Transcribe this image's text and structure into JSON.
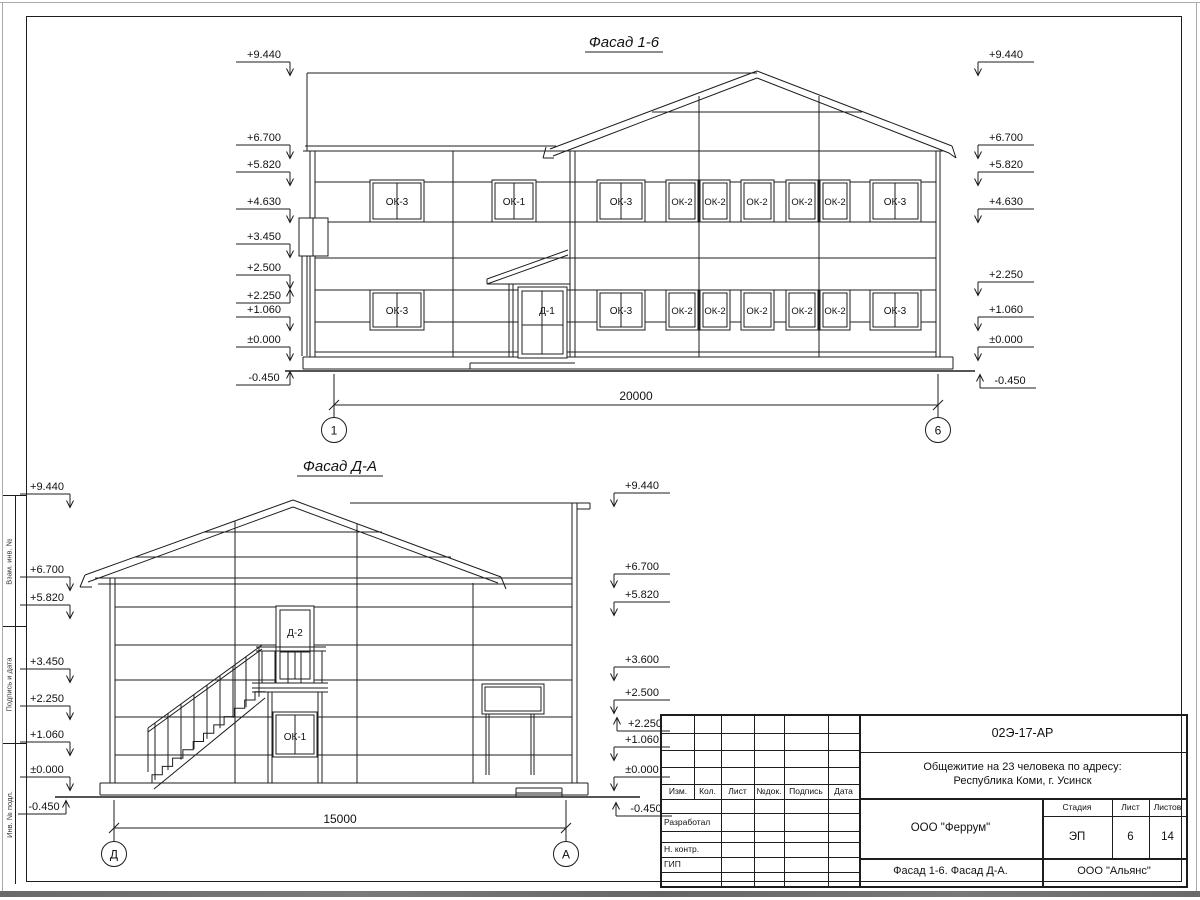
{
  "sheet": {
    "margin_labels": [
      "Взам. инв. №",
      "Подпись и дата",
      "Инв. № подл."
    ]
  },
  "facade_16": {
    "title": "Фасад 1-6",
    "marks_left": [
      "+9.440",
      "+6.700",
      "+5.820",
      "+4.630",
      "+3.450",
      "+2.500",
      "+2.250",
      "+1.060",
      "±0.000",
      "-0.450"
    ],
    "marks_right": [
      "+9.440",
      "+6.700",
      "+5.820",
      "+4.630",
      "+2.250",
      "+1.060",
      "±0.000",
      "-0.450"
    ],
    "upper_windows": [
      "ОК-3",
      "ОК-1",
      "ОК-3",
      "ОК-2",
      "ОК-2",
      "ОК-2",
      "ОК-2",
      "ОК-2",
      "ОК-3"
    ],
    "lower_windows": [
      "ОК-3",
      "ОК-3",
      "ОК-2",
      "ОК-2",
      "ОК-2",
      "ОК-2",
      "ОК-2",
      "ОК-3"
    ],
    "door_label": "Д-1",
    "dimension": "20000",
    "axis_left": "1",
    "axis_right": "6"
  },
  "facade_da": {
    "title": "Фасад Д-А",
    "marks_left": [
      "+9.440",
      "+6.700",
      "+5.820",
      "+3.450",
      "+2.250",
      "+1.060",
      "±0.000",
      "-0.450"
    ],
    "marks_right": [
      "+9.440",
      "+6.700",
      "+5.820",
      "+3.600",
      "+2.500",
      "+2.250",
      "+1.060",
      "±0.000",
      "-0.450"
    ],
    "door_label": "Д-2",
    "window_label": "ОК-1",
    "dimension": "15000",
    "axis_left": "Д",
    "axis_right": "А"
  },
  "title_block": {
    "doc_number": "02Э-17-АР",
    "project_line1": "Общежитие на 23 человека по адресу:",
    "project_line2": "Республика Коми, г. Усинск",
    "col_izm": "Изм.",
    "col_kol": "Кол.",
    "col_list": "Лист",
    "col_dok": "№док.",
    "col_podpis": "Подпись",
    "col_data": "Дата",
    "row_razrabotal": "Разработал",
    "row_nkontr": "Н. контр.",
    "row_gip": "ГИП",
    "org": "ООО \"Феррум\"",
    "stage_label": "Стадия",
    "sheet_label": "Лист",
    "sheets_label": "Листов",
    "stage": "ЭП",
    "sheet_no": "6",
    "sheets_total": "14",
    "drawing_title": "Фасад 1-6. Фасад Д-А.",
    "contractor": "ООО \"Альянс\""
  }
}
